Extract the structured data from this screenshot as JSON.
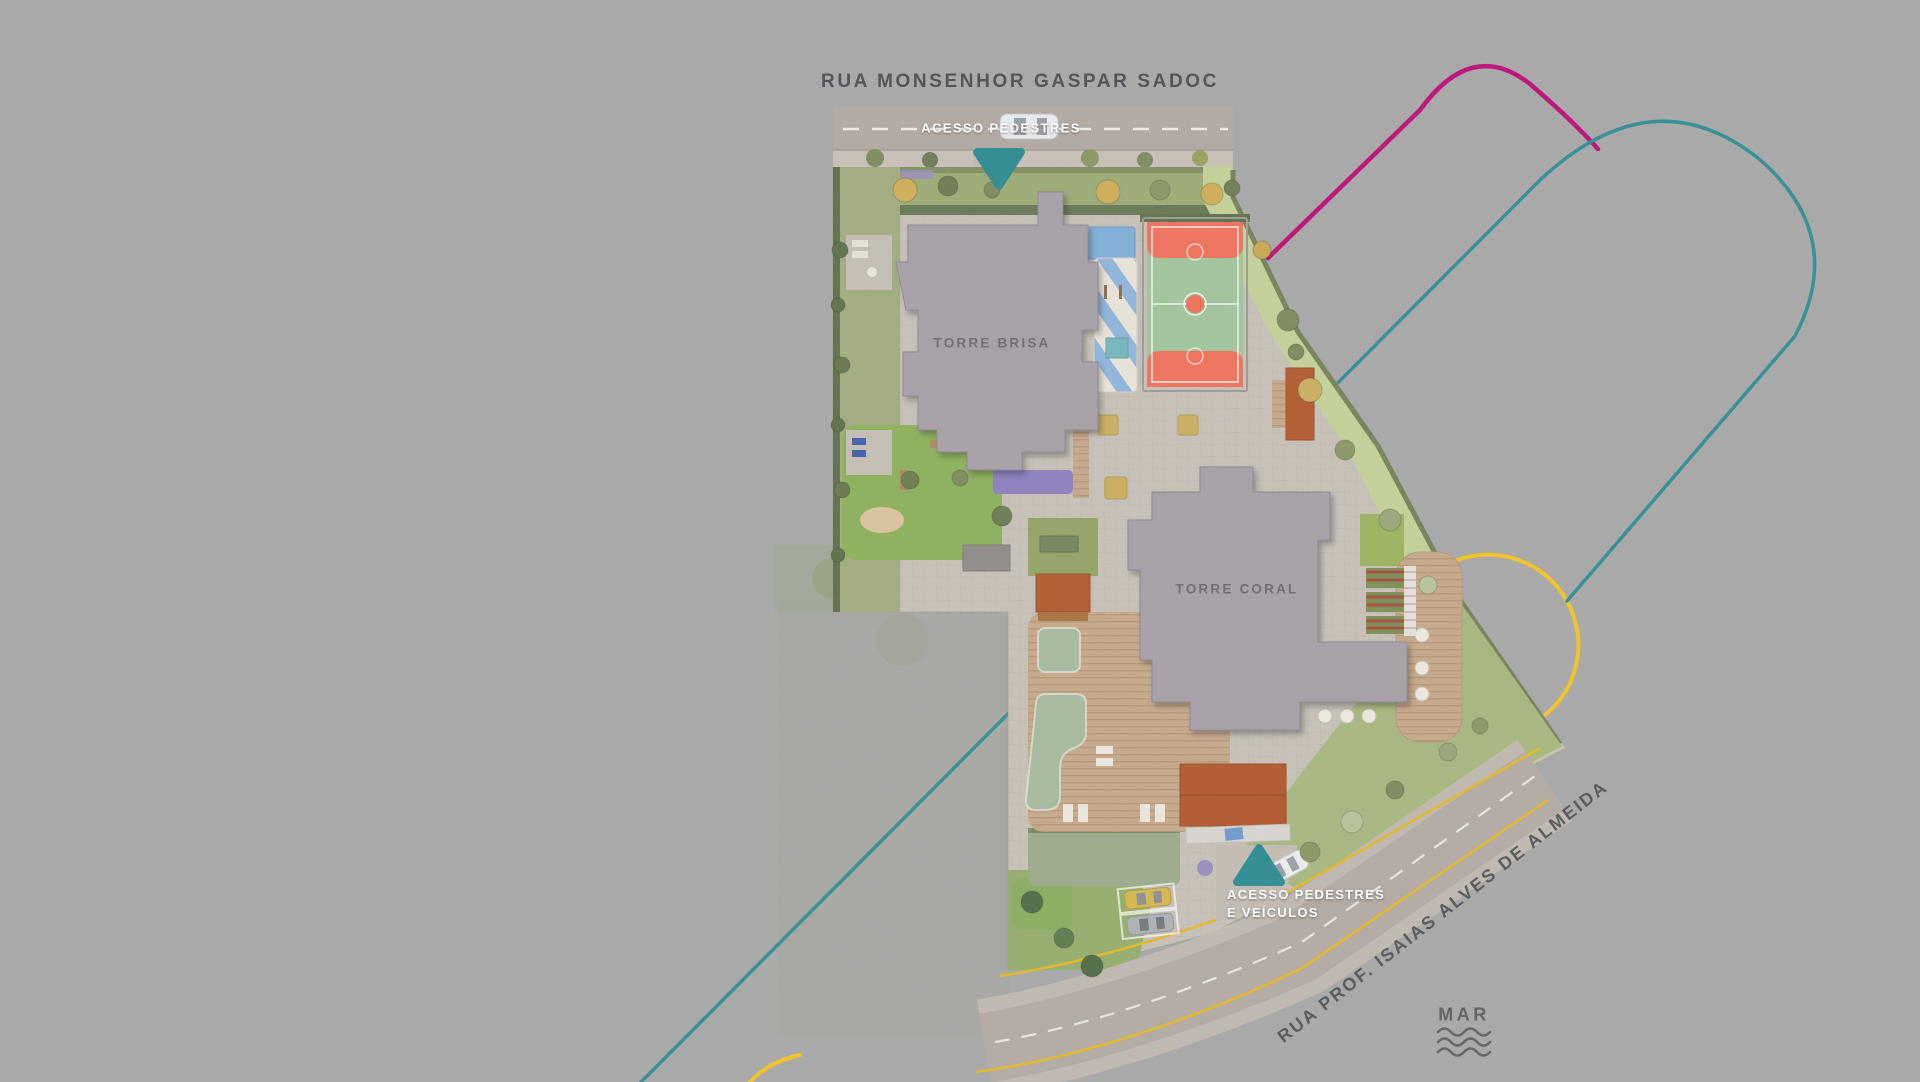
{
  "streets": {
    "top": "RUA MONSENHOR GASPAR SADOC",
    "diagonal": "RUA PROF. ISAIAS ALVES DE ALMEIDA"
  },
  "access_points": {
    "top_label": "ACESSO PEDESTRES",
    "bottom_label_line1": "ACESSO PEDESTRES",
    "bottom_label_line2": "E VEÍCULOS",
    "marker_icon": "triangle-access-icon",
    "marker_color": "#2b8c93"
  },
  "towers": {
    "brisa": "TORRE BRISA",
    "coral": "TORRE CORAL"
  },
  "sea": {
    "label": "MAR",
    "icon": "waves-icon"
  },
  "colors": {
    "background_gray": "#a9a9a9",
    "deco_magenta": "#bf0b7c",
    "deco_teal": "#2e8e96",
    "deco_yellow": "#f6c51f",
    "street_label": "#54555a",
    "court_green": "#a2c79c",
    "court_orange": "#f4715a",
    "pool_blue": "#7fb0da",
    "splash_stripe_blue": "#8fb6dd",
    "building_gray": "#a8a1a8",
    "deck_wood": "#c9aa8b",
    "pavilion_orange": "#b4572b",
    "lawn_green": "#9dac74",
    "pavers": "#c9c2b9",
    "asphalt": "#b3aaa3"
  }
}
